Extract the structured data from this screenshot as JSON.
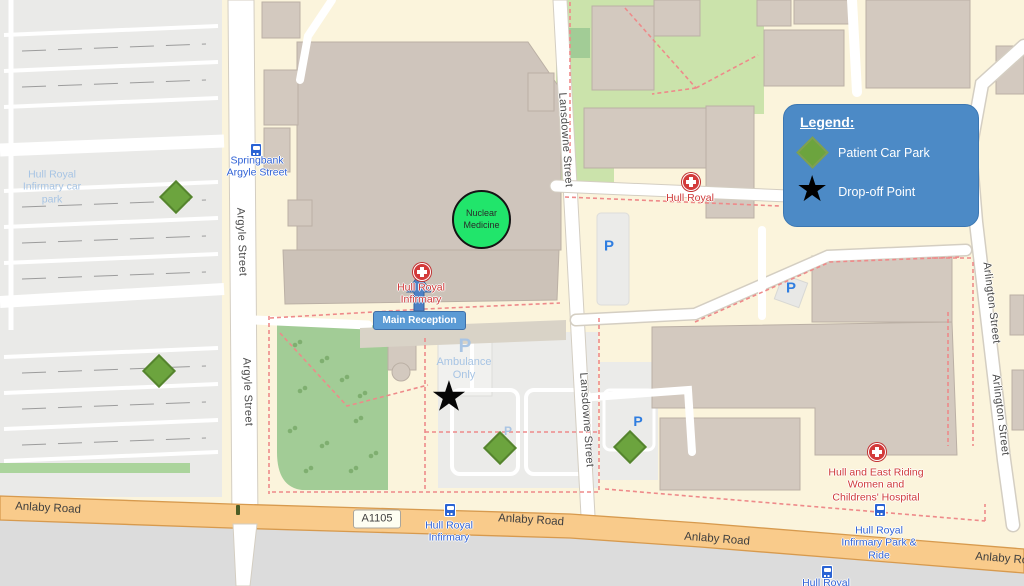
{
  "colors": {
    "map_background": "#FBF4DC",
    "building_fill": "#D3C9BF",
    "car_park_fill": "#EAEAE8",
    "park_green": "#A2CC96",
    "main_road_orange": "#F9CB8B",
    "legend_bg": "#4C8AC6",
    "patient_car_park_green": "#6CA43E",
    "drop_off_black": "#000000",
    "reception_blue": "#5B9BD5",
    "nuclear_medicine_green": "#21E56B",
    "path_dashed_red": "#EE8A8A"
  },
  "icons": {
    "star": "★",
    "parking_glyph": "P"
  },
  "legend": {
    "title": "Legend:",
    "items": [
      {
        "icon": "patient-car-park-diamond",
        "label": "Patient Car Park"
      },
      {
        "icon": "drop-off-star",
        "label": "Drop-off Point"
      }
    ]
  },
  "annotations": {
    "nuclear_medicine": "Nuclear Medicine",
    "main_reception": "Main Reception"
  },
  "streets": {
    "argyle": "Argyle Street",
    "lansdowne": "Lansdowne Street",
    "arlington": "Arlington Street",
    "anlaby": "Anlaby Road",
    "route_a1105": "A1105",
    "springbank": "Springbank Argyle Street"
  },
  "map_labels": {
    "car_park": "Hull Royal Infirmary car park",
    "hull_royal": "Hull Royal",
    "hull_royal_infirmary": "Hull Royal Infirmary",
    "ambulance_only": "Ambulance Only",
    "women_childrens_hospital": "Hull and East Riding Women and Childrens' Hospital",
    "bus_stop_infirmary": "Hull Royal Infirmary",
    "park_and_ride": "Hull Royal Infirmary Park & Ride",
    "bus_stop_hull_royal": "Hull Royal"
  }
}
